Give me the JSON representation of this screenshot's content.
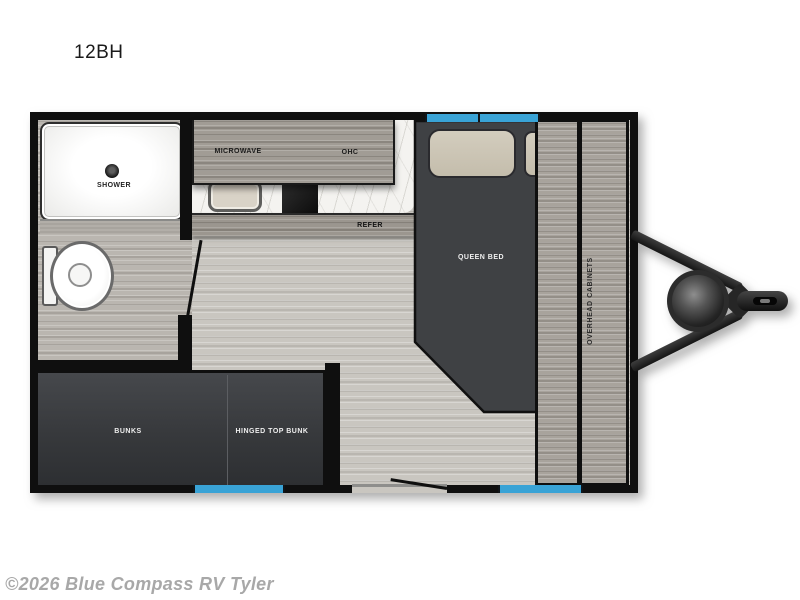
{
  "page": {
    "title": "12BH",
    "watermark": "©2026 Blue Compass RV Tyler"
  },
  "floorplan": {
    "model": "12BH",
    "labels": {
      "shower": "SHOWER",
      "microwave": "MICROWAVE",
      "ohc": "OHC",
      "refer": "REFER",
      "queen_bed": "QUEEN BED",
      "overhead_cabinets": "OVERHEAD CABINETS",
      "bunks": "BUNKS",
      "hinged_top_bunk": "HINGED TOP BUNK"
    },
    "features": {
      "windows": [
        "front window over queen bed",
        "rear window at bunks",
        "rear window at cabinets"
      ],
      "entry": "side entry door with outward-swinging leaf",
      "tongue": "A-frame tongue with propane tank and coupler"
    },
    "colors": {
      "window_blue": "#39a3d6",
      "wall_black": "#0f0f0f",
      "furniture_dark": "#3f4144",
      "floor_gray": "#c9c6c0",
      "cabinet_wood": "#a19c95",
      "counter_marble": "#f4f3f0",
      "watermark_gray": "#a8a8a8"
    }
  }
}
